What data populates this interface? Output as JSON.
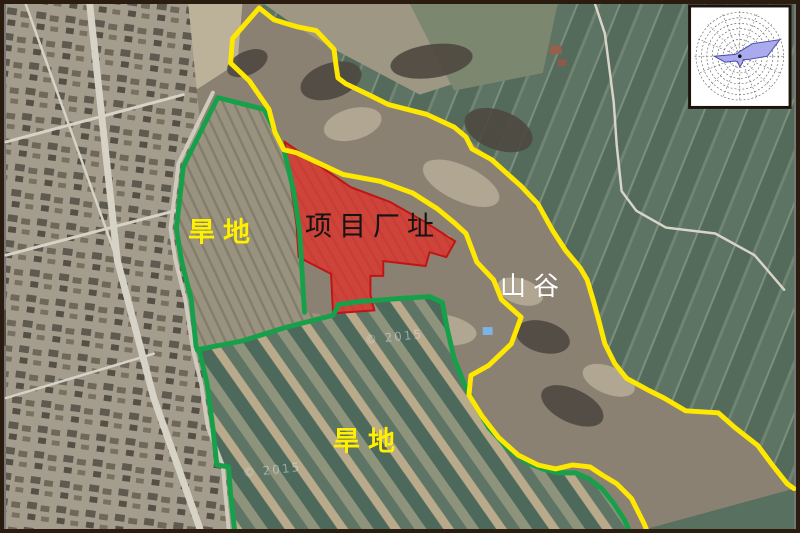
{
  "figure": {
    "type": "annotated-satellite-map",
    "labels": {
      "dryland_top": "旱地",
      "project_site": "项目厂址",
      "valley": "山谷",
      "dryland_bottom": "旱地"
    },
    "watermark": "© 2015",
    "colors": {
      "boundary_yellow": "#ffe800",
      "boundary_green": "#17a04a",
      "site_fill": "#e42b25",
      "site_stroke": "#c11414",
      "rose_fill": "#a9abee",
      "rose_stroke": "#4a4aa5"
    },
    "geometry": {
      "yellow_boundary": "650,533 648,528 635,502 620,487 605,478 593,470 575,468 558,472 540,468 520,458 500,440 483,418 470,397 472,377 490,367 513,345 523,318 503,300 495,280 478,262 467,233 455,222 438,208 413,192 380,180 342,173 310,158 295,151 282,148 273,130 267,107 247,78 228,60 230,35 257,4 272,16 295,23 315,27 333,46 335,62 337,75 345,81 368,92 388,102 427,112 455,125 467,135 473,147 493,158 523,185 540,203 555,230 568,250 583,268 590,280 596,300 602,322 608,345 618,365 630,380 652,392 668,400 690,413 723,415 740,430 763,448 778,468 793,487 800,492",
      "green_outer": "232,533 228,498 226,470 214,468 210,430 204,385 197,355 193,348 188,300 178,260 173,228 180,165 215,95 262,107 282,147 292,190 298,230 300,262 303,313",
      "green_divider": "194,351 240,342 285,328 332,316",
      "green_right": "332,316 338,305 360,302 400,299 430,297 443,303 448,330 455,360 465,385 475,405 490,430 508,450 528,465 545,472 560,476 578,476 592,482 605,492 617,507 628,524 632,533",
      "site_polygon": "283,140 350,186 390,201 425,221 456,241 447,257 430,252 426,266 383,261 383,276 370,276 370,295 374,311 332,314 330,274 297,257 295,225",
      "rose_petal": "773,53 785.6,36.2 757.7,40.3 747.7,46.5 745,48 743.5,49.3 742.2,50.2 740.4,51.1 719,53 730.2,59.1 740.1,57.9 742.7,58.5 745,64 747.7,59.5 748.5,56.5 753.3,56.4"
    }
  }
}
